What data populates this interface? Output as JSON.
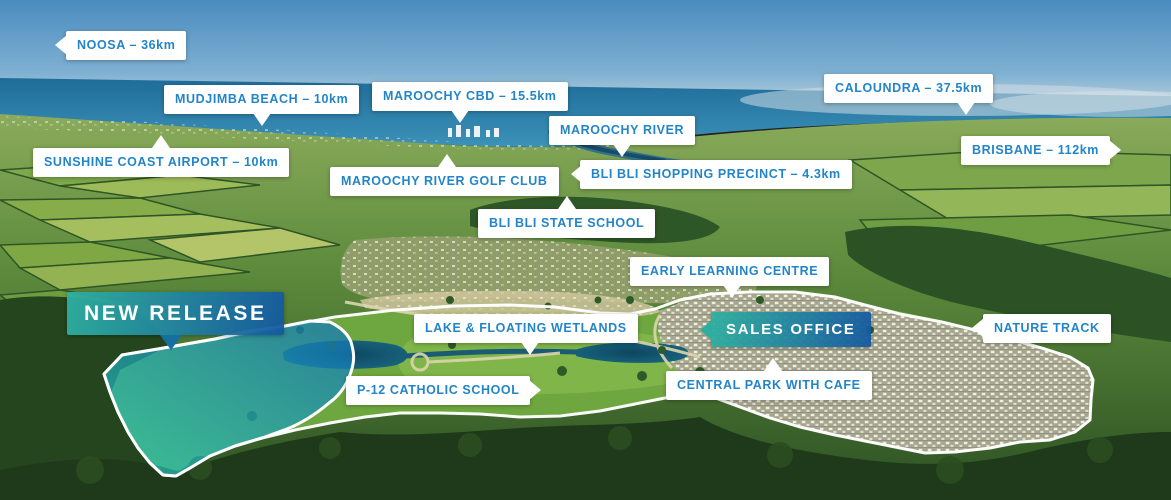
{
  "map": {
    "kind": "aerial-masterplan-location-map",
    "colors": {
      "label_text_blue": "#2385c8",
      "callout_background": "#ffffff",
      "gradient_teal": "#2eb0a0",
      "gradient_blue": "#14589f",
      "site_boundary_line": "#ffffff",
      "new_release_overlay": "#1fb9ae",
      "sky": "#4e8fc0",
      "ocean": "#2a7fa6"
    }
  },
  "callouts": {
    "noosa": {
      "text": "NOOSA – 36km",
      "arrow": "left"
    },
    "mudjimba_beach": {
      "text": "MUDJIMBA BEACH – 10km",
      "arrow": "down"
    },
    "maroochy_cbd": {
      "text": "MAROOCHY CBD – 15.5km",
      "arrow": "down"
    },
    "maroochy_river": {
      "text": "MAROOCHY RIVER",
      "arrow": "down"
    },
    "caloundra": {
      "text": "CALOUNDRA – 37.5km",
      "arrow": "down"
    },
    "sunshine_coast_airport": {
      "text": "SUNSHINE COAST AIRPORT – 10km",
      "arrow": "up"
    },
    "maroochy_river_golf_club": {
      "text": "MAROOCHY RIVER GOLF CLUB",
      "arrow": "up"
    },
    "bli_bli_shopping_precinct": {
      "text": "BLI BLI SHOPPING PRECINCT – 4.3km",
      "arrow": "left"
    },
    "bli_bli_state_school": {
      "text": "BLI BLI STATE SCHOOL",
      "arrow": "up"
    },
    "early_learning_centre": {
      "text": "EARLY LEARNING CENTRE",
      "arrow": "down"
    },
    "new_release": {
      "text": "NEW RELEASE",
      "arrow": "down",
      "style": "gradient"
    },
    "lake_floating_wetlands": {
      "text": "LAKE & FLOATING WETLANDS",
      "arrow": "down"
    },
    "sales_office": {
      "text": "SALES OFFICE",
      "arrow": "left",
      "style": "gradient"
    },
    "nature_track": {
      "text": "NATURE TRACK",
      "arrow": "left"
    },
    "p12_catholic_school": {
      "text": "P-12 CATHOLIC SCHOOL",
      "arrow": "right"
    },
    "central_park_with_cafe": {
      "text": "CENTRAL PARK WITH CAFE",
      "arrow": "up"
    },
    "brisbane": {
      "text": "BRISBANE – 112km",
      "arrow": "right"
    }
  }
}
